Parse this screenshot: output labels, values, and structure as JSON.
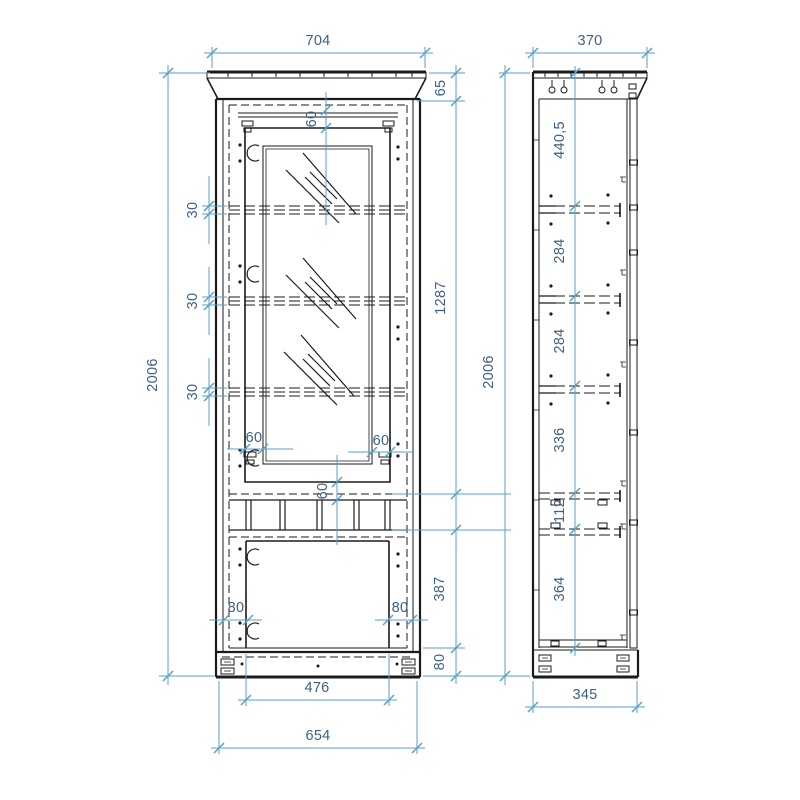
{
  "colors": {
    "dimension_line": "#57a0cb",
    "dimension_text": "#3d5f82",
    "drawing_line": "#1b1b1b",
    "background": "#ffffff"
  },
  "front_view": {
    "dims": {
      "overall_width": "704",
      "overall_height": "2006",
      "cornice_height": "65",
      "top_rail": "60",
      "glass_door_height": "1287",
      "shelf_thickness_top": "30",
      "shelf_thickness_middle": "30",
      "shelf_thickness_bottom": "30",
      "stile_left": "60",
      "stile_right": "60",
      "niche_gap": "60",
      "door_offset_left": "80",
      "door_offset_right": "80",
      "lower_door_height": "387",
      "plinth_height": "80",
      "lower_panel_width": "476",
      "body_width": "654"
    }
  },
  "side_view": {
    "dims": {
      "overall_depth": "370",
      "overall_height": "2006",
      "section_top": "440,5",
      "section_2": "284",
      "section_3": "284",
      "section_4": "336",
      "niche_height": "112",
      "section_bottom": "364",
      "plinth_depth": "345"
    }
  }
}
